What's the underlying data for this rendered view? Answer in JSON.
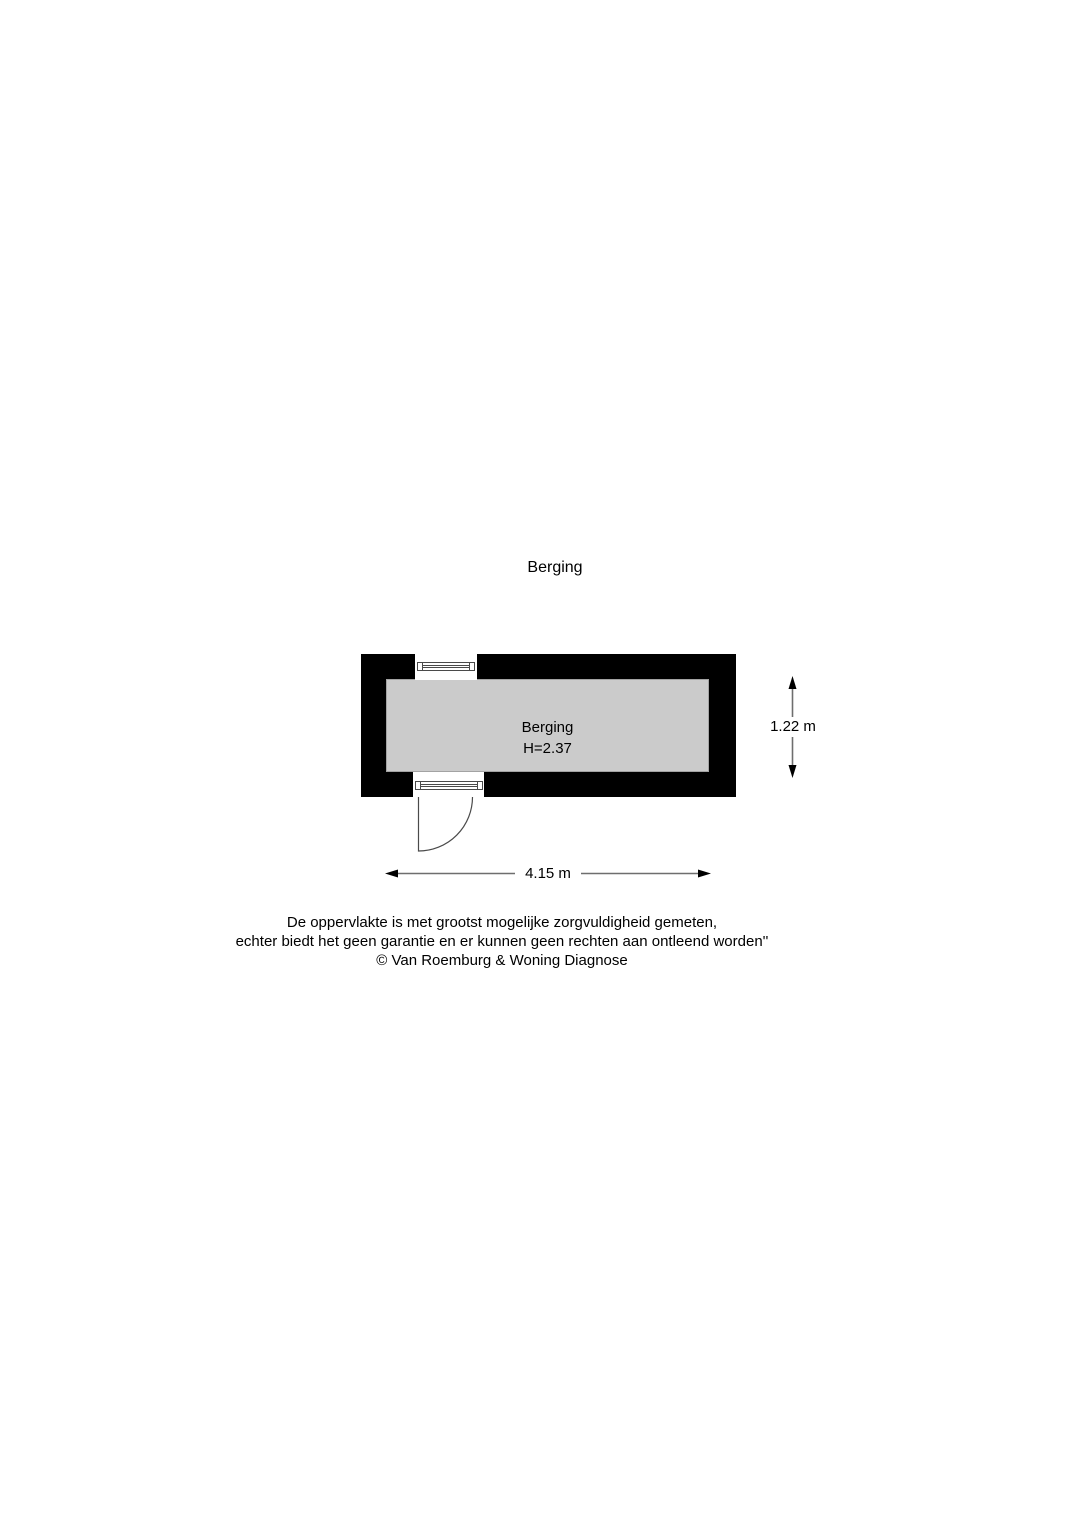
{
  "floorplan": {
    "title": "Berging",
    "room": {
      "name": "Berging",
      "ceiling_height_label": "H=2.37"
    },
    "dimensions": {
      "width_label": "4.15 m",
      "height_label": "1.22 m"
    },
    "disclaimer": {
      "line1": "De oppervlakte is met grootst mogelijke zorgvuldigheid gemeten,",
      "line2": "echter biedt het geen garantie en er kunnen geen rechten aan ontleend worden''",
      "line3": "© Van Roemburg & Woning Diagnose"
    },
    "colors": {
      "wall": "#000000",
      "floor": "#cbcbcb",
      "dimension_line": "#6e6e6e",
      "symbol_line": "#4a4a4a"
    }
  }
}
